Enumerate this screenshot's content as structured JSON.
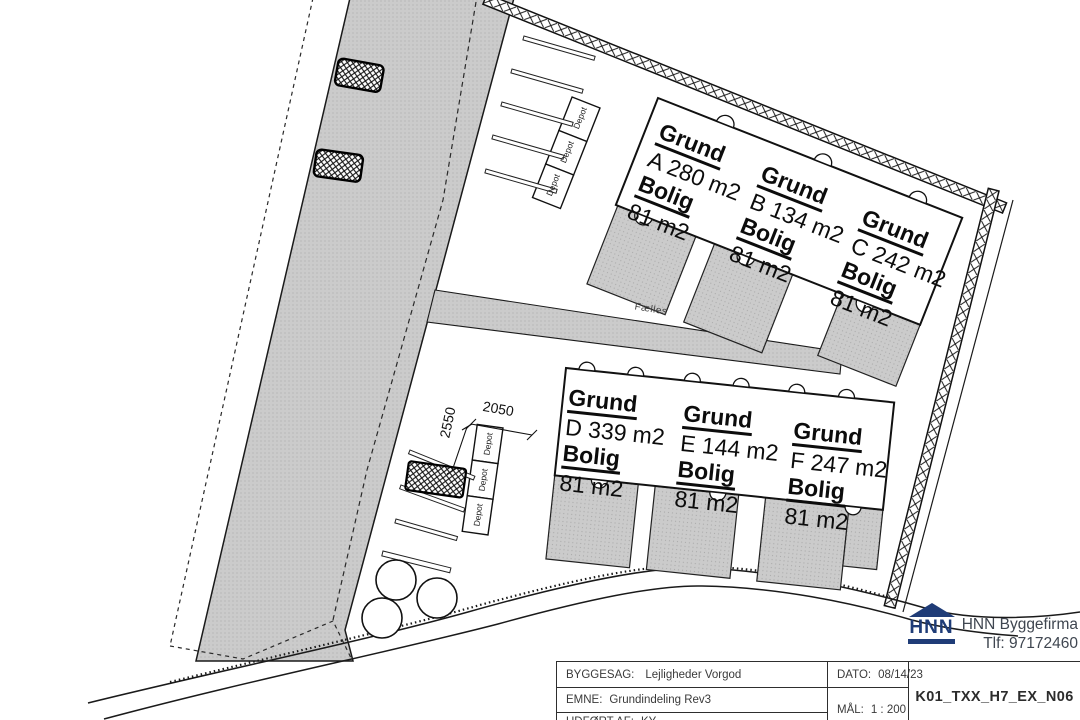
{
  "plots": {
    "a": {
      "grund_label": "Grund",
      "grund_value": "A 280 m2",
      "bolig_label": "Bolig",
      "bolig_value": "81 m2"
    },
    "b": {
      "grund_label": "Grund",
      "grund_value": "B 134 m2",
      "bolig_label": "Bolig",
      "bolig_value": "81 m2"
    },
    "c": {
      "grund_label": "Grund",
      "grund_value": "C 242 m2",
      "bolig_label": "Bolig",
      "bolig_value": "81 m2"
    },
    "d": {
      "grund_label": "Grund",
      "grund_value": "D 339 m2",
      "bolig_label": "Bolig",
      "bolig_value": "81 m2"
    },
    "e": {
      "grund_label": "Grund",
      "grund_value": "E 144 m2",
      "bolig_label": "Bolig",
      "bolig_value": "81 m2"
    },
    "f": {
      "grund_label": "Grund",
      "grund_value": "F 247 m2",
      "bolig_label": "Bolig",
      "bolig_value": "81 m2"
    }
  },
  "site": {
    "depot_label": "Depot",
    "faelles_label": "Fælles",
    "dim_width": "2050",
    "dim_depth": "2550"
  },
  "titleblock": {
    "byggesag_label": "BYGGESAG:",
    "byggesag_value": "Lejligheder Vorgod",
    "emne_label": "EMNE:",
    "emne_value": "Grundindeling Rev3",
    "udfoert_label": "UDFØRT AF:",
    "udfoert_value": "KY",
    "dato_label": "DATO:",
    "dato_value": "08/14/23",
    "maal_label": "MÅL:",
    "maal_value": "1 : 200",
    "drawing_no": "K01_TXX_H7_EX_N06"
  },
  "logo": {
    "monogram": "HNN",
    "company": "HNN Byggefirma",
    "phone": "Tlf: 97172460"
  },
  "colors": {
    "logo_navy": "#1f3c77",
    "plan_gray": "#cbcbcb",
    "line_black": "#1a1a1a"
  }
}
